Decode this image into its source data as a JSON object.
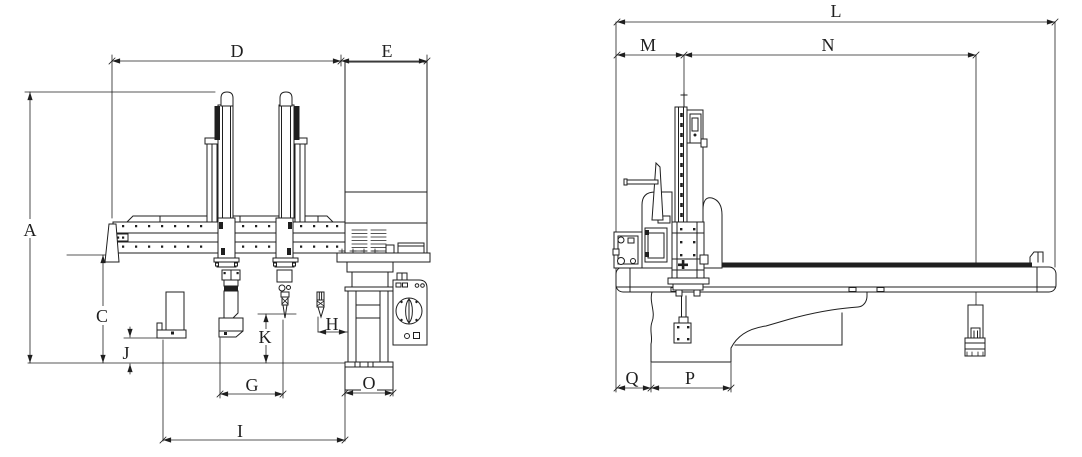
{
  "colors": {
    "line": "#1f1f1f",
    "background": "#ffffff"
  },
  "drawing": {
    "type": "technical-dimension-drawing",
    "subject": "gantry take-out robot, front and side elevation views",
    "views": [
      {
        "id": "front-view",
        "dimensions": [
          "A",
          "C",
          "D",
          "E",
          "G",
          "H",
          "I",
          "J",
          "K",
          "O"
        ]
      },
      {
        "id": "side-view",
        "dimensions": [
          "L",
          "M",
          "N",
          "P",
          "Q"
        ]
      }
    ]
  },
  "dims": {
    "A": "A",
    "C": "C",
    "D": "D",
    "E": "E",
    "G": "G",
    "H": "H",
    "I": "I",
    "J": "J",
    "K": "K",
    "L": "L",
    "M": "M",
    "N": "N",
    "O": "O",
    "P": "P",
    "Q": "Q"
  }
}
